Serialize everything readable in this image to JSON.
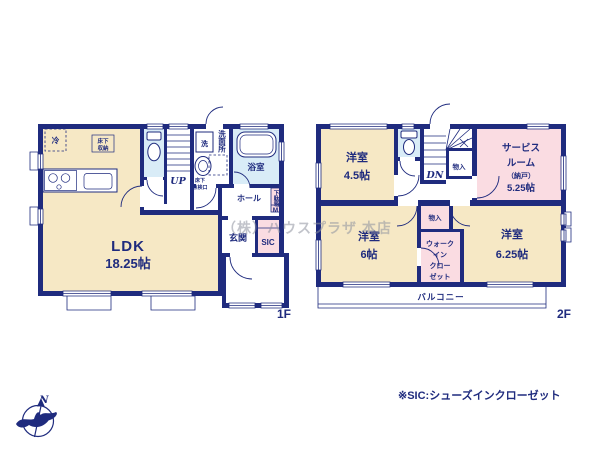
{
  "colors": {
    "wall": "#1f2b7e",
    "room_cream": "#f6e8c5",
    "room_pink": "#fadce2",
    "room_blue": "#d9ecf7",
    "text": "#1f2b7e",
    "watermark": "#8f93a0"
  },
  "watermark": "（株）ハウスプラザ 本店",
  "footnote": "※SIC:シューズインクローゼット",
  "compass": {
    "north": "N"
  },
  "floor1": {
    "label": "1F",
    "ldk_name": "LDK",
    "ldk_size": "18.25帖",
    "fridge": "冷",
    "floor_storage_1": "床下",
    "floor_storage_2": "収納",
    "stairs": "UP",
    "washer": "洗",
    "washroom": "洗面所",
    "inspection_1": "床下",
    "inspection_2": "点検口",
    "bathroom": "浴室",
    "hall": "ホール",
    "shoe_box": "下駄箱",
    "shoe_box_m": "M",
    "entrance": "玄関",
    "sic": "SIC"
  },
  "floor2": {
    "label": "2F",
    "room45_name": "洋室",
    "room45_size": "4.5帖",
    "stairs": "DN",
    "closet_a": "物入",
    "closet_b": "物入",
    "service_1": "サービス",
    "service_2": "ルーム",
    "service_3": "（納戸）",
    "service_4": "5.25帖",
    "room6_name": "洋室",
    "room6_size": "6帖",
    "wic_1": "ウォーク",
    "wic_2": "イン",
    "wic_3": "クロー",
    "wic_4": "ゼット",
    "room625_name": "洋室",
    "room625_size": "6.25帖",
    "balcony": "バルコニー"
  }
}
